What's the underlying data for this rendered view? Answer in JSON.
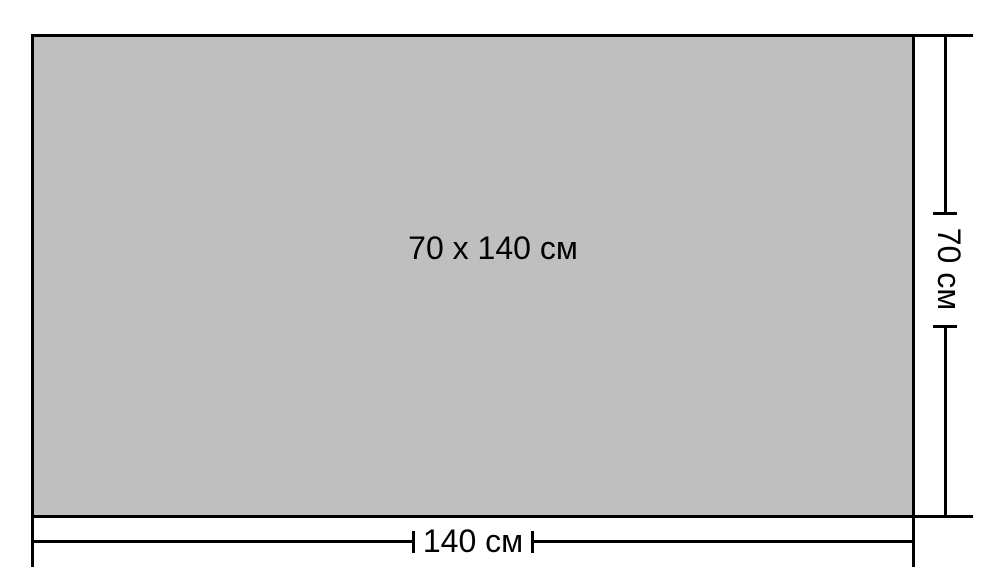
{
  "diagram": {
    "center_label": "70 x 140 см",
    "bottom_dimension": {
      "label": "140 см"
    },
    "right_dimension": {
      "label": "70 см"
    }
  },
  "colors": {
    "rect-fill": "#bfbfbf",
    "line": "#000000",
    "background": "#ffffff",
    "text": "#000000"
  }
}
